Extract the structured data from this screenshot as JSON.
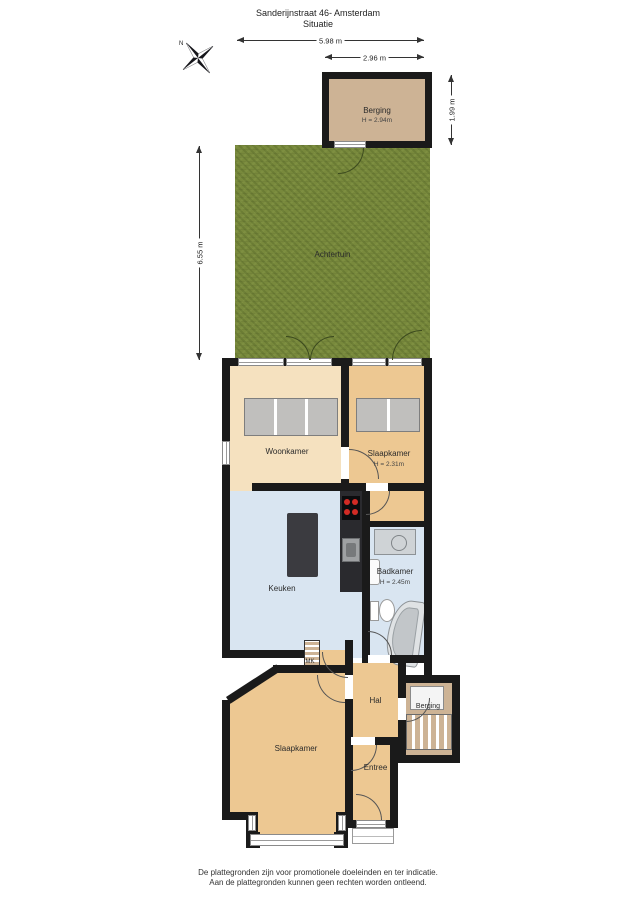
{
  "title": {
    "line1": "Sanderijnstraat 46- Amsterdam",
    "line2": "Situatie"
  },
  "compass": {
    "north_label": "N"
  },
  "dimensions": {
    "garden_width": "5.98 m",
    "shed_width": "2.96 m",
    "shed_depth": "1.99 m",
    "garden_depth": "6.55 m"
  },
  "rooms": {
    "shed": {
      "name": "Berging",
      "height": "H = 2.94m"
    },
    "garden": {
      "name": "Achtertuin"
    },
    "living": {
      "name": "Woonkamer"
    },
    "bedroom1": {
      "name": "Slaapkamer",
      "height": "H = 2.31m"
    },
    "kitchen": {
      "name": "Keuken"
    },
    "bathroom": {
      "name": "Badkamer",
      "height": "H = 2.45m"
    },
    "bedroom2": {
      "name": "Slaapkamer"
    },
    "hall": {
      "name": "Hal"
    },
    "entry": {
      "name": "Entree"
    },
    "storage": {
      "name": "Berging"
    },
    "meter_cupboard": {
      "name": "MK"
    }
  },
  "footer": {
    "line1": "De plattegronden zijn voor promotionele doeleinden en ter indicatie.",
    "line2": "Aan de plattegronden kunnen geen rechten worden ontleend."
  },
  "colors": {
    "wall": "#1a1a1a",
    "garden": "#78893c",
    "wood_floor": "#edc892",
    "living_floor": "#f5e1bf",
    "tile_floor": "#d9e5f1",
    "shed_floor": "#cdb395",
    "closet": "#c0bfbd",
    "island": "#3b3b40",
    "burner_red": "#d22b25"
  }
}
